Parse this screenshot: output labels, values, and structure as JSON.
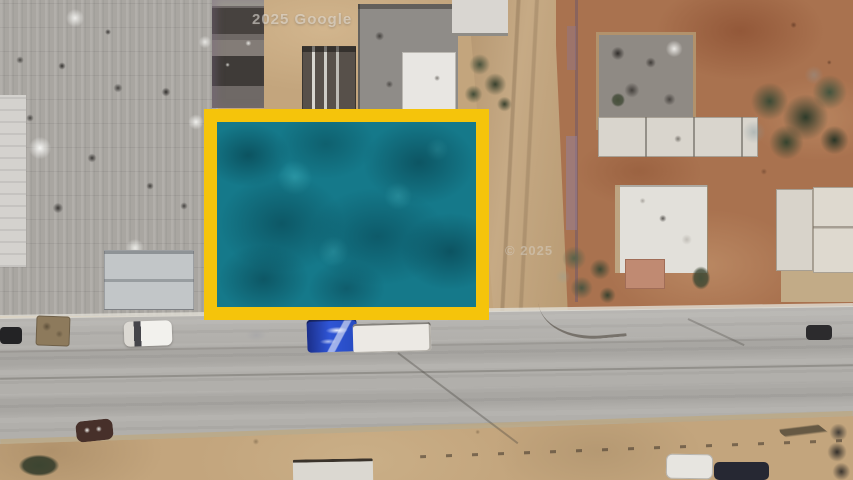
{
  "map_view": {
    "description": "Aerial satellite photo of a desert town block; a vacant lot is highlighted with a yellow rectangle filled with a teal overlay",
    "watermarks": {
      "top": "2025 Google",
      "mid": "© 2025"
    },
    "highlighted_parcel": {
      "label": "selected-parcel",
      "border_color": "#F5C40B",
      "fill_color": "#15798A"
    },
    "palette": {
      "dirt_tan": "#C3A57D",
      "dirt_red": "#A9724F",
      "road_asphalt": "#B1AFAB",
      "industrial_roof_gray": "#A9A6A1",
      "white_roof": "#E2E0DA",
      "tree_green": "#3A4733",
      "truck_blue": "#2F55D6",
      "truck_trailer_white": "#ECE9E4"
    },
    "features": {
      "roads": [
        "horizontal-paved-street",
        "vertical-dirt-road"
      ],
      "vehicles": [
        "black-car",
        "rust-colored-object",
        "white-pickup-truck",
        "dark-sedan",
        "blue-semi-truck-with-white-trailer",
        "dark-car",
        "maroon-car",
        "white-trailer",
        "white-car",
        "dark-blue-car",
        "gold-car"
      ],
      "vegetation": [
        "large-tree",
        "roadside-shrubs",
        "mid-block-shrubs",
        "small-bush"
      ]
    }
  }
}
